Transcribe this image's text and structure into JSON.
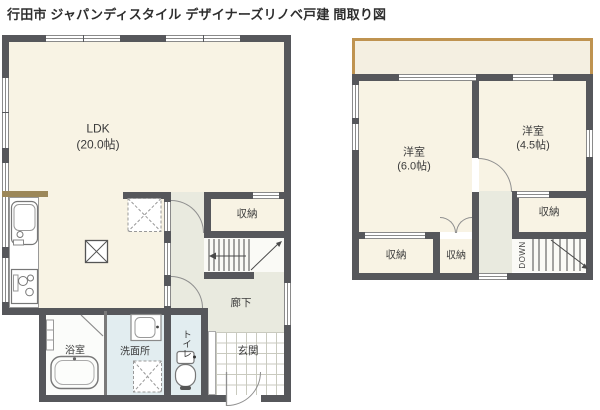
{
  "title": "行田市 ジャパンディスタイル デザイナーズリノベ戸建 間取り図",
  "floor1": {
    "ldk": {
      "label": "LDK",
      "size": "(20.0帖)"
    },
    "storage": "収納",
    "hallway": "廊下",
    "entrance": "玄関",
    "toilet": "トイレ",
    "washroom": "洗面所",
    "bathroom": "浴室"
  },
  "floor2": {
    "room1": {
      "label": "洋室",
      "size": "(6.0帖)"
    },
    "room2": {
      "label": "洋室",
      "size": "(4.5帖)"
    },
    "storage_left": "収納",
    "storage_middle": "収納",
    "storage_right": "収納",
    "stairs_down": "DOWN"
  },
  "icons": [
    "kitchen-sink-icon",
    "stove-icon",
    "bathtub-icon",
    "washbasin-icon",
    "toilet-icon",
    "washing-machine-space-icon",
    "refrigerator-space-icon",
    "pillar-icon",
    "stairs-up-icon",
    "stairs-down-icon"
  ],
  "colors": {
    "wall": "#56575b",
    "room": "#f8f3e4",
    "hall": "#e9eadf",
    "wet": "#e2edf0",
    "bath": "#fbfcfa",
    "stairbg": "#fafaf6",
    "balcony": "#bf9350",
    "counter": "#9c8759",
    "tile": "#c9cabf",
    "line": "#8a8a8a"
  }
}
